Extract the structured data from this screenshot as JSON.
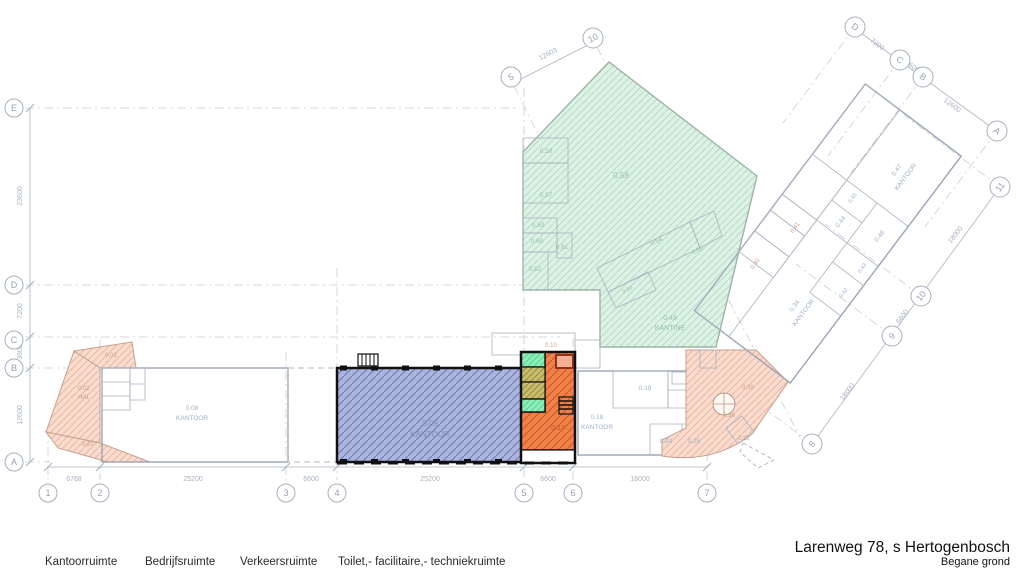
{
  "title": {
    "line1": "Larenweg 78, s Hertogenbosch",
    "line2": "Begane grond"
  },
  "legend": {
    "items": [
      {
        "label": "Kantoorruimte"
      },
      {
        "label": "Bedrijfsruimte"
      },
      {
        "label": "Verkeersruimte"
      },
      {
        "label": "Toilet,- facilitaire,- techniekruimte"
      }
    ]
  },
  "grid": {
    "bottom": [
      "1",
      "2",
      "3",
      "4",
      "5",
      "6",
      "7"
    ],
    "left": [
      "E",
      "D",
      "C",
      "B",
      "A"
    ],
    "top": [
      "5",
      "10"
    ],
    "topRight": [
      "D",
      "C",
      "B",
      "A"
    ],
    "right": [
      "11",
      "10",
      "9",
      "8"
    ]
  },
  "dims": {
    "bottom": [
      "6768",
      "25200",
      "6600",
      "25200",
      "6600",
      "18000"
    ],
    "left": [
      "23600",
      "7200",
      "3600",
      "12600"
    ],
    "top": [
      "12603"
    ],
    "topRight": [
      "7200",
      "3600",
      "12600"
    ],
    "right": [
      "18000",
      "6600",
      "18000"
    ]
  },
  "labels": {
    "r01": "0.01",
    "r02": "0.02",
    "hal": "HAL",
    "r07": "0.07",
    "r08": "0.08",
    "r08name": "KANTOOR",
    "r09": "0.09",
    "r09name": "KANTOOR",
    "r10": "0.10",
    "r17": "0.17",
    "r18": "0.18",
    "r18name": "KANTOOR",
    "r19": "0.19",
    "r24": "0.24",
    "r25": "0.25",
    "r22": "0.22",
    "r36": "0.36",
    "r39": "0.39",
    "r34": "0.34",
    "r34name": "KANTOOR",
    "r40": "0.40",
    "r41": "0.41",
    "r42": "0.42",
    "r43": "0.43",
    "r44": "0.44",
    "r45": "0.45",
    "r46": "0.46",
    "r47": "0.47",
    "r47name": "KANTOOR",
    "r49": "0.49",
    "r49name": "KANTINE",
    "r50": "0.50",
    "r53": "0.53",
    "r54": "0.54",
    "r56": "0.56",
    "r57": "0.57",
    "r58": "0.58",
    "r59": "0.59",
    "r60": "0.60",
    "r61": "0.61",
    "r62": "0.62"
  },
  "colors": {
    "highlight_blue": "#abb5dd",
    "highlight_orange": "#f0804a",
    "teal": "#8aeeb8",
    "olive": "#c9bc6e",
    "faded_green": "#ddf2e5",
    "faded_blue": "#d2e2f3",
    "faded_salmon": "#f8dbce",
    "wall_black": "#111111"
  }
}
